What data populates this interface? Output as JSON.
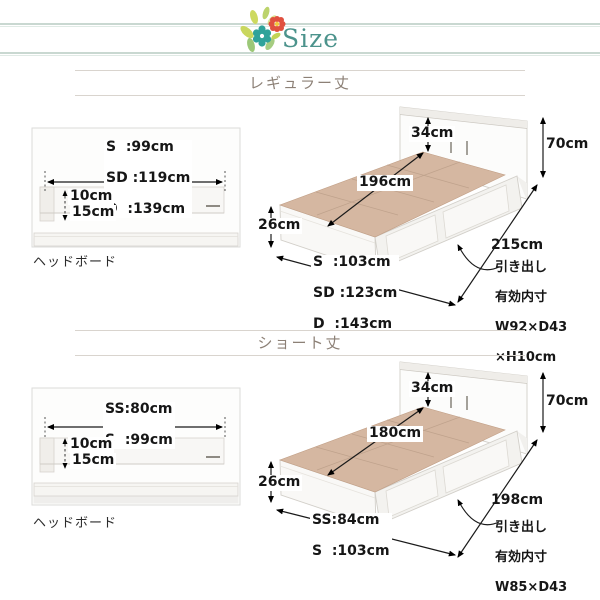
{
  "header": {
    "title": "Size"
  },
  "sections": [
    {
      "title": "レギュラー丈",
      "headboard": {
        "size_lines": [
          "S  :99cm",
          "SD :119cm",
          "D  :139cm"
        ],
        "depth_top": "10cm",
        "depth_bottom": "15cm",
        "caption": "ヘッドボード"
      },
      "bed": {
        "shelf_height": "34cm",
        "total_height": "70cm",
        "inner_length": "196cm",
        "base_height": "26cm",
        "total_length": "215cm",
        "width_lines": [
          "S  :103cm",
          "SD :123cm",
          "D  :143cm"
        ],
        "drawer_lines": [
          "引き出し",
          "有効内寸",
          "W92×D43",
          "×H10cm"
        ]
      }
    },
    {
      "title": "ショート丈",
      "headboard": {
        "size_lines": [
          "SS:80cm",
          "S  :99cm"
        ],
        "depth_top": "10cm",
        "depth_bottom": "15cm",
        "caption": "ヘッドボード"
      },
      "bed": {
        "shelf_height": "34cm",
        "total_height": "70cm",
        "inner_length": "180cm",
        "base_height": "26cm",
        "total_length": "198cm",
        "width_lines": [
          "SS:84cm",
          "S  :103cm"
        ],
        "drawer_lines": [
          "引き出し",
          "有効内寸",
          "W85×D43",
          "×H10cm"
        ]
      }
    }
  ],
  "colors": {
    "accent_teal": "#4c938c",
    "flower_teal": "#2fa39a",
    "flower_red": "#e0503f",
    "leaf_green": "#c9d75e",
    "title_brown": "#8c8076",
    "platform_tan": "#d5b7a1",
    "header_line": "#c9d8d1"
  }
}
